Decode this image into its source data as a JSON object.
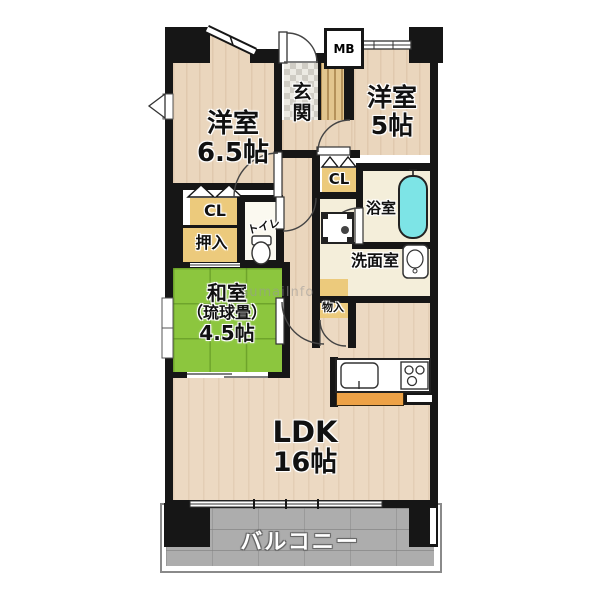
{
  "labels": {
    "yoshitsu65_name": "洋室",
    "yoshitsu65_size": "6.5帖",
    "yoshitsu5_name": "洋室",
    "yoshitsu5_size": "5帖",
    "genkan": "玄関",
    "mb": "MB",
    "cl_left": "CL",
    "cl_right": "CL",
    "oshiire": "押入",
    "toilet": "トイレ",
    "bath": "浴室",
    "washroom": "洗面室",
    "monoire": "物入",
    "washitsu_name": "和室",
    "washitsu_sub": "（琉球畳）",
    "washitsu_size": "4.5帖",
    "ldk_name": "LDK",
    "ldk_size": "16帖",
    "balcony": "バルコニー",
    "watermark": "SumaiInfo"
  },
  "colors": {
    "wall": "#161616",
    "wood_floor": "#ead6bd",
    "tatami_green": "#8cc63e",
    "closet_tan": "#ecca7c",
    "bathtub_cyan": "#7de4e6",
    "balcony_gray": "#adadad",
    "counter_orange": "#eda247"
  }
}
